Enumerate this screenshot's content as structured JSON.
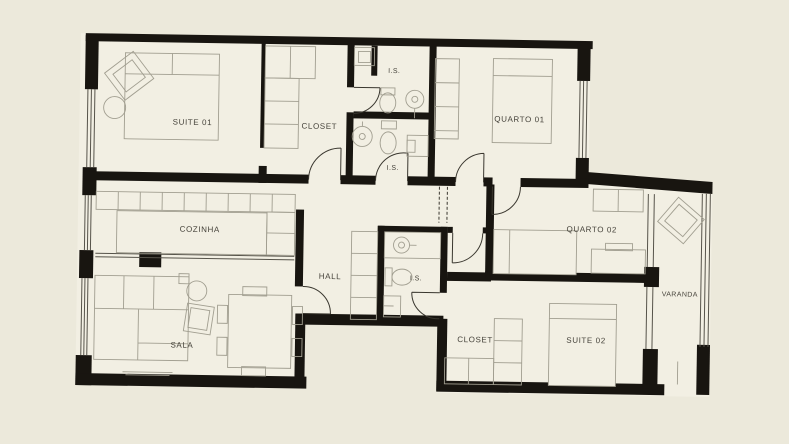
{
  "plan": {
    "type": "apartment-floor-plan",
    "rooms": [
      {
        "id": "suite-01",
        "label": "SUITE 01"
      },
      {
        "id": "closet-top",
        "label": "CLOSET"
      },
      {
        "id": "is-top",
        "label": "I.S."
      },
      {
        "id": "is-mid",
        "label": "I.S."
      },
      {
        "id": "quarto-01",
        "label": "QUARTO 01"
      },
      {
        "id": "cozinha",
        "label": "COZINHA"
      },
      {
        "id": "hall",
        "label": "HALL"
      },
      {
        "id": "is-hall",
        "label": "I.S."
      },
      {
        "id": "quarto-02",
        "label": "QUARTO 02"
      },
      {
        "id": "varanda",
        "label": "VARANDA"
      },
      {
        "id": "sala",
        "label": "SALA"
      },
      {
        "id": "closet-bottom",
        "label": "CLOSET"
      },
      {
        "id": "suite-02",
        "label": "SUITE 02"
      }
    ],
    "colors": {
      "background": "#ece9db",
      "floor": "#f2efe3",
      "wall": "#181510",
      "furniture_line": "#a19e90",
      "door_line": "#3a372f",
      "label_text": "#46433b"
    }
  }
}
